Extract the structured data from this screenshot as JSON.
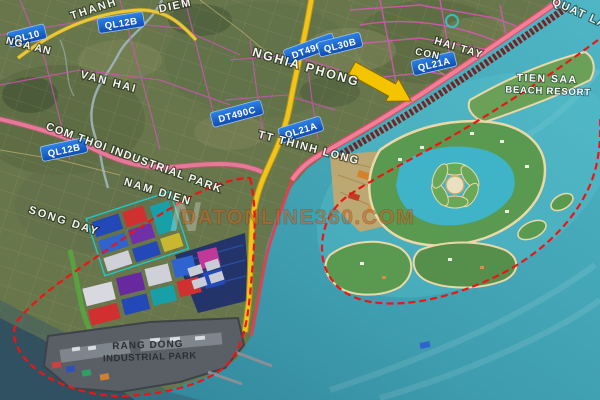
{
  "map": {
    "watermark": {
      "logo": "N",
      "text": "DATONLINE360.COM"
    },
    "road_badges": {
      "ql10": "QL10",
      "ql12b_top": "QL12B",
      "dt490c_top": "DT490C",
      "ql30b": "QL30B",
      "ql21a_con": "QL21A",
      "dt490c_mid": "DT490C",
      "ql12b_mid": "QL12B",
      "ql21a_mid": "QL21A"
    },
    "place_labels": {
      "thanh": "THANH",
      "diem": "DIEM",
      "nga_an": "NGA AN",
      "van_hai": "VAN HAI",
      "nghia_phong": "NGHIA PHONG",
      "hai_tay": "HAI TAY",
      "con": "CON",
      "quat_lam": "QUAT LA",
      "nam_dien": "NAM DIEN",
      "song_day": "SONG DAY",
      "tt_thinh_long": "TT THINH LONG"
    },
    "area_labels": {
      "com_thoi": "COM THOI INDUSTRIAL PARK",
      "tien_sa_line1": "TIEN SAA",
      "tien_sa_line2": "BEACH RESORT",
      "rang_dong_line1": "RANG DONG",
      "rang_dong_line2": "INDUSTRIAL PARK"
    },
    "colors": {
      "sea": "#3f9fb0",
      "land": "#68764c",
      "boundary_red": "#ee1414",
      "road_yellow": "#f2c41a",
      "road_pink": "#e87898",
      "badge_blue": "#1f63cc",
      "arrow_yellow": "#f5c400",
      "watermark_orange": "#c66424"
    }
  }
}
